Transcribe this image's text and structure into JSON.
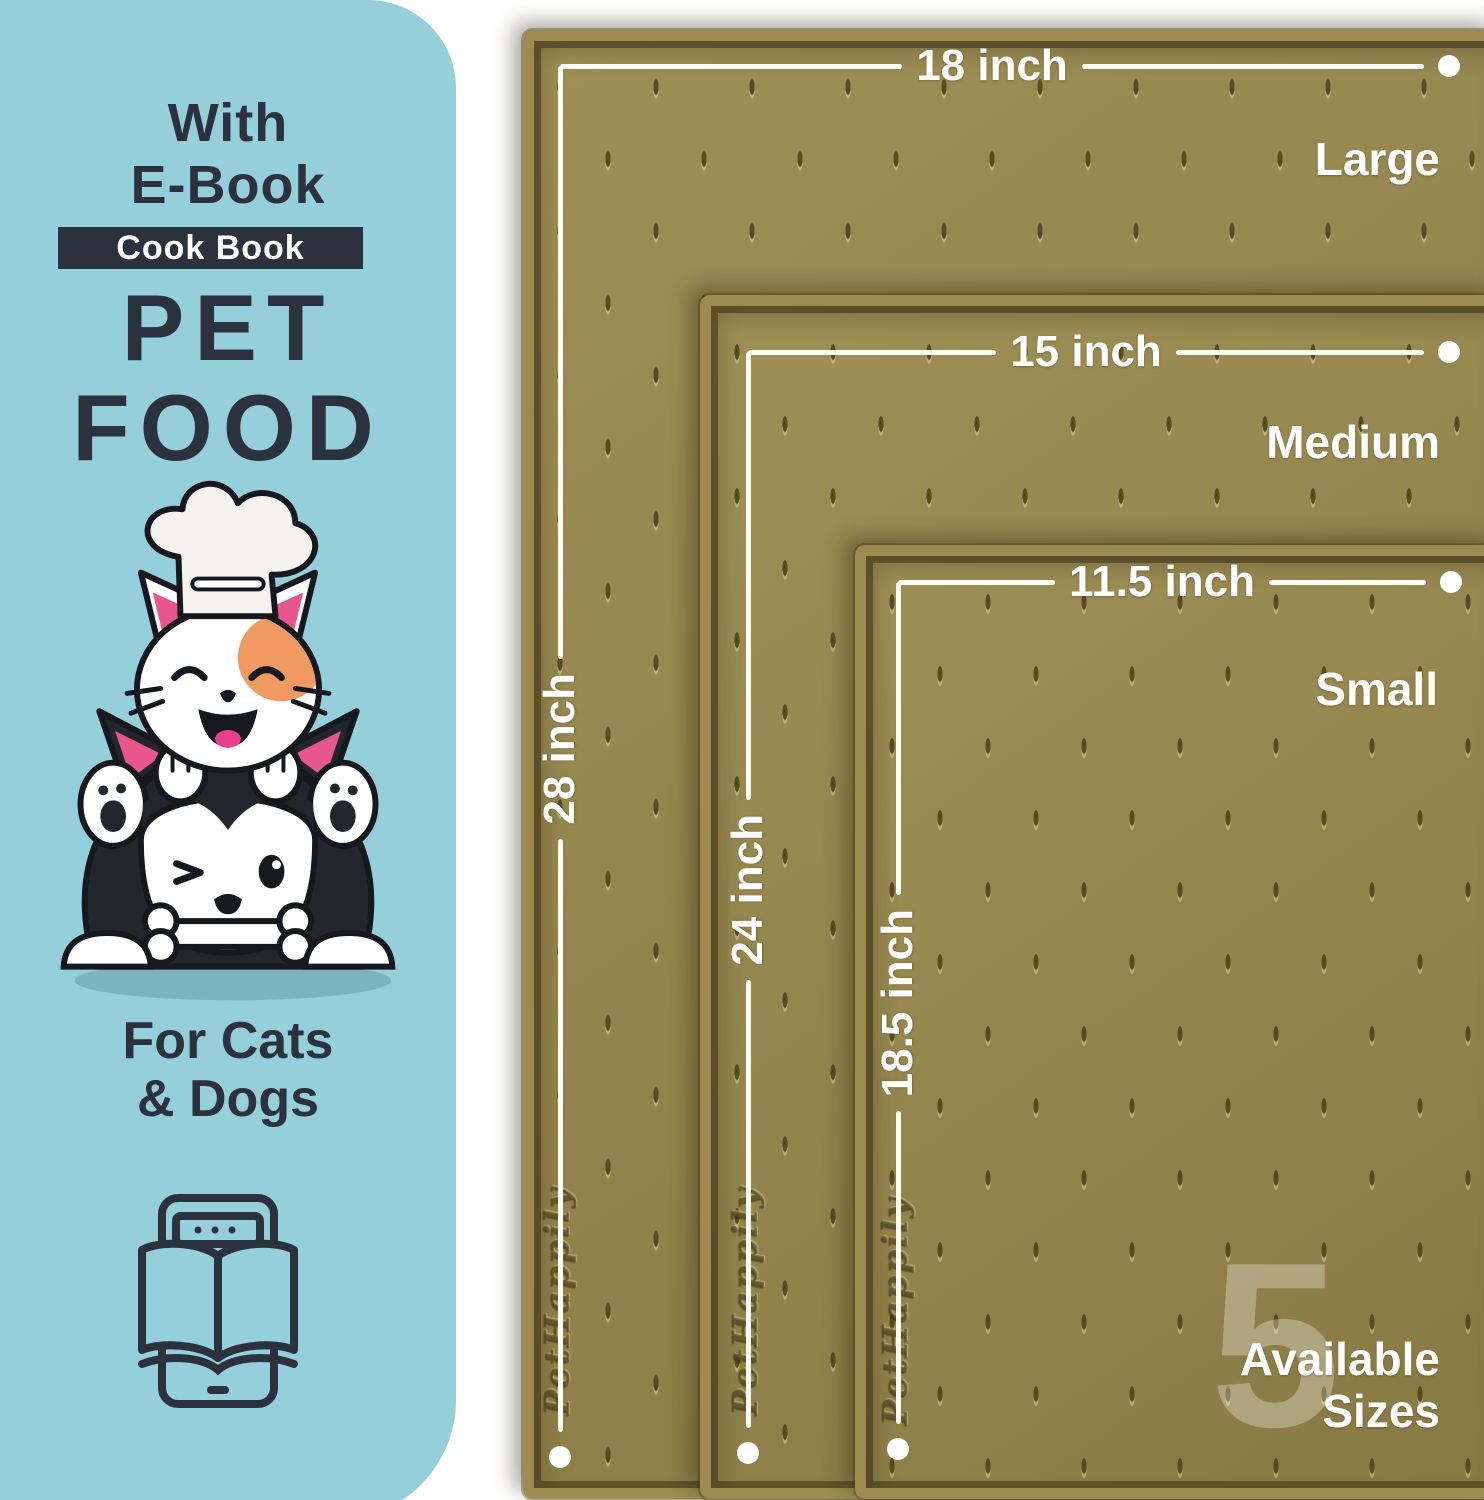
{
  "panel": {
    "heading": {
      "line1": "With",
      "line2": "E-Book"
    },
    "badge_label": "Cook Book",
    "title": {
      "line1": "PET",
      "line2": "FOOD"
    },
    "audience": {
      "line1": "For Cats",
      "line2": "& Dogs"
    }
  },
  "mats": [
    {
      "size_name": "Large",
      "width_label": "18 inch",
      "height_label": "28 inch"
    },
    {
      "size_name": "Medium",
      "width_label": "15 inch",
      "height_label": "24 inch"
    },
    {
      "size_name": "Small",
      "width_label": "11.5 inch",
      "height_label": "18.5 inch"
    }
  ],
  "sizes_badge": {
    "count": "5",
    "line1": "Available",
    "line2": "Sizes"
  },
  "brand_embossed": "PetHappily",
  "colors": {
    "panel_blue": "#94cfda",
    "ink_dark": "#2b323d",
    "mat_olive": "#97874a",
    "mat_rim": "#9c8c50",
    "measure_white": "#ffffff",
    "patch_orange": "#f09a62",
    "pink": "#e8578c"
  }
}
